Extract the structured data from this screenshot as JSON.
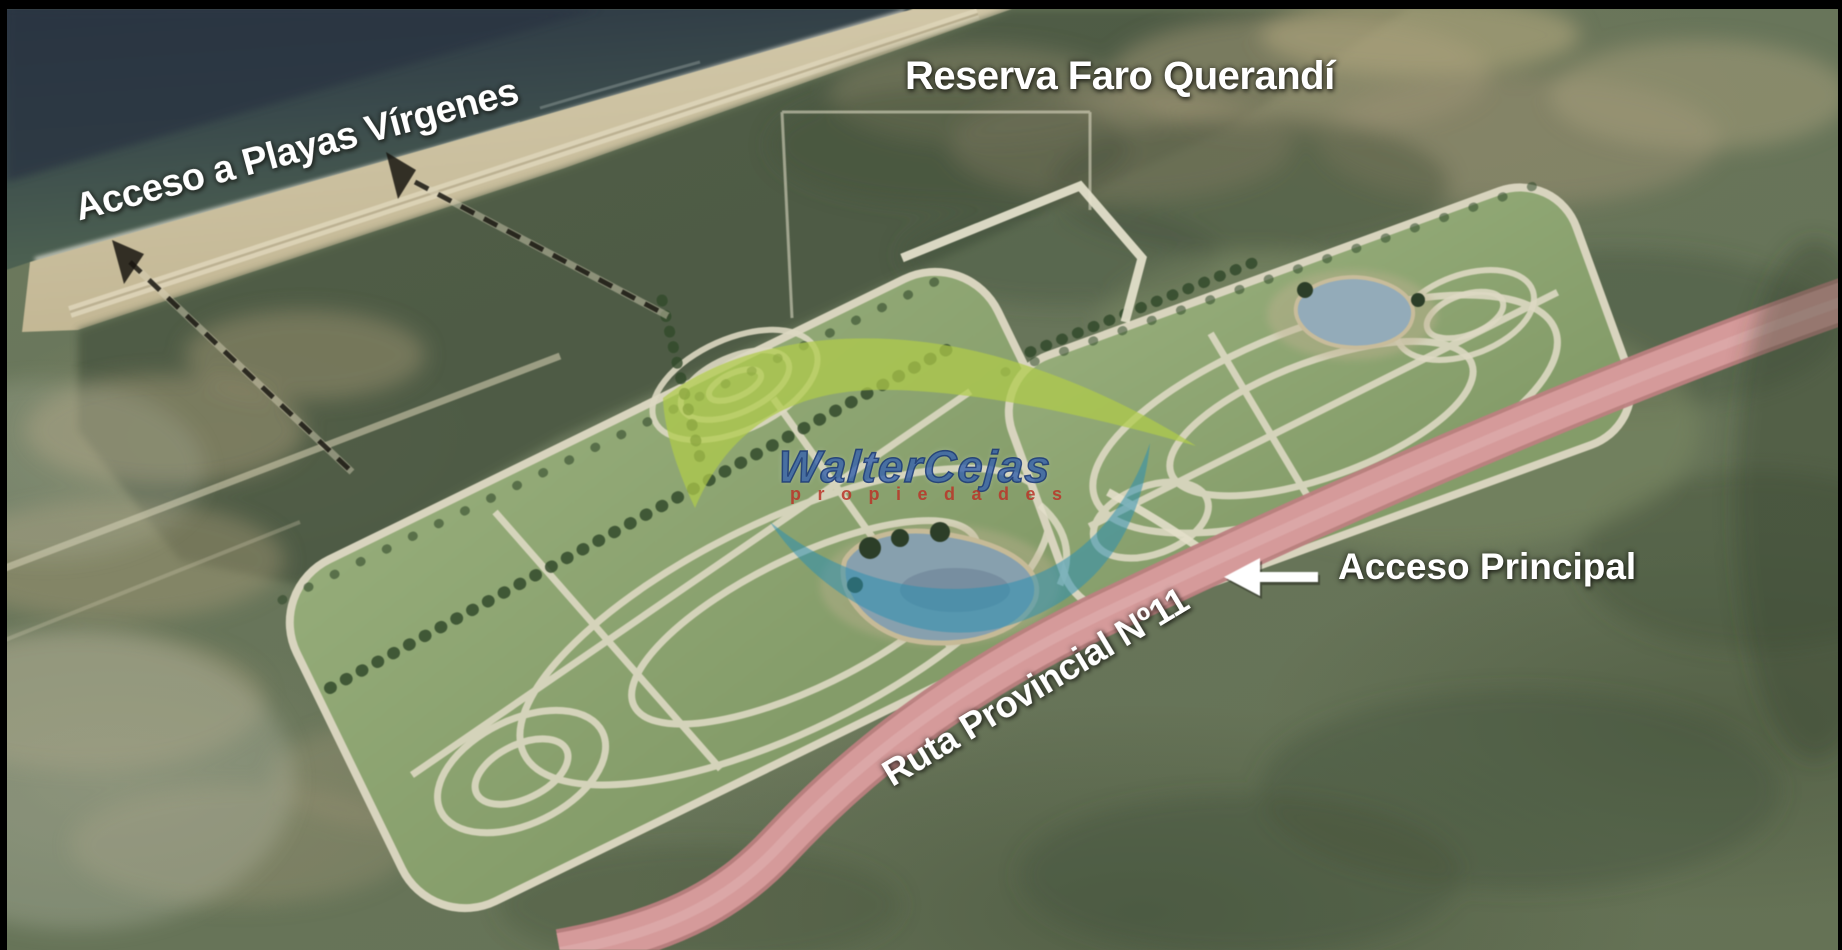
{
  "labels": {
    "reserve": "Reserva Faro Querandí",
    "beach_access": "Acceso a Playas Vírgenes",
    "main_access": "Acceso Principal",
    "route": "Ruta Provincial Nº11"
  },
  "watermark": {
    "brand": "WalterCejas",
    "tagline": "propiedades"
  },
  "colors": {
    "label_text": "#ffffff",
    "ocean_deep": "#2c3744",
    "ocean_shallow": "#4b5f51",
    "sand": "#cfc5a6",
    "coastal_scrub": "#4c5843",
    "terrain_olive": "#6d7a5e",
    "parcel_green": "#8ba471",
    "internal_road": "#ddd9c3",
    "lake_blue": "#8aa2b0",
    "highway_pink": "#d59a9a",
    "dashed_path": "#17150f",
    "watermark_blue": "#3a68b0",
    "watermark_red": "#c04a3a",
    "watermark_green": "#b0cc49"
  }
}
